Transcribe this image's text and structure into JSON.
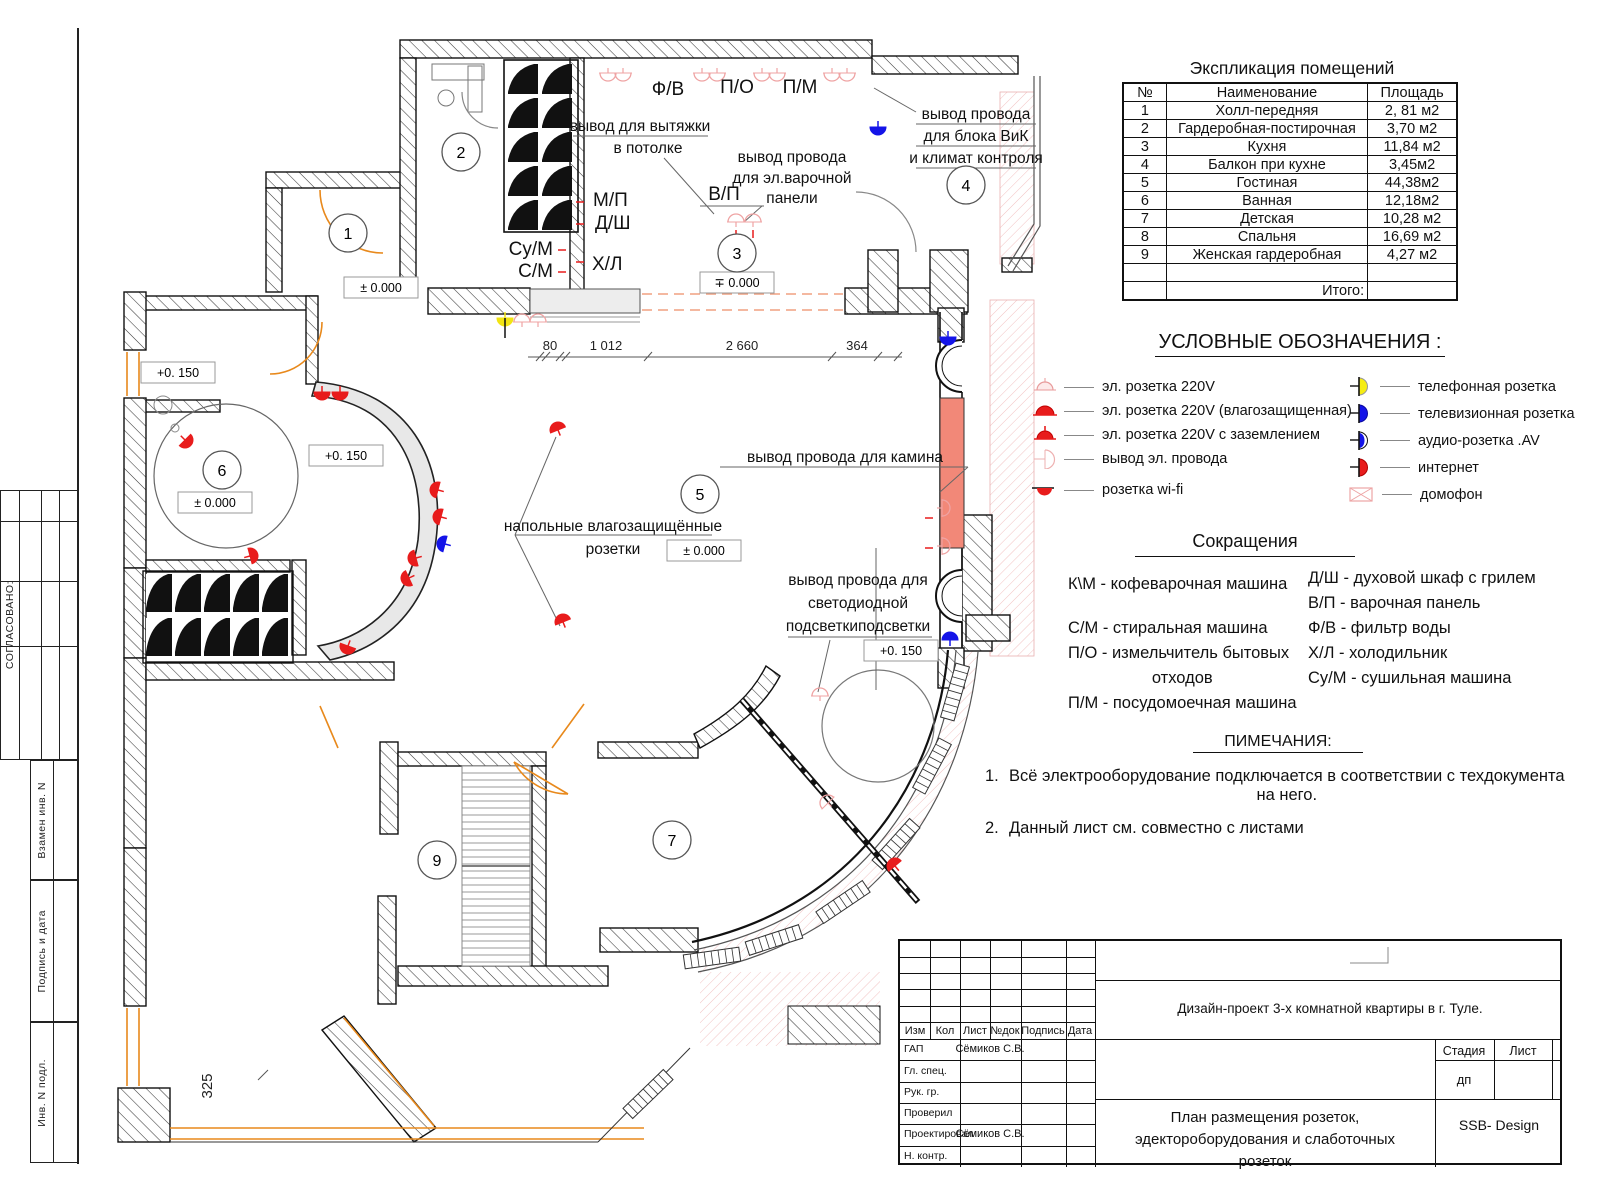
{
  "colors": {
    "socket_red": "#e81c1c",
    "socket_pale": "#efa3a3",
    "socket_blue": "#1414e8",
    "socket_yellow": "#f2e413",
    "fireplace": "#f28878",
    "door_orange": "#e8891c"
  },
  "stamp_column": {
    "approved": "СОГЛАСОВАНО:",
    "rows": [
      "Взамен инв. N",
      "Подпись и дата",
      "Инв. N подл."
    ]
  },
  "plan": {
    "rooms": [
      "1",
      "2",
      "3",
      "4",
      "5",
      "6",
      "7",
      "9"
    ],
    "appliance_labels": {
      "fv": "Ф/В",
      "po": "П/О",
      "pm": "П/М",
      "vp": "В/П",
      "mp": "М/П",
      "dsh": "Д/Ш",
      "sum": "Су/М",
      "sm": "С/М",
      "hl": "Х/Л"
    },
    "annotations": {
      "hood_1": "вывод для вытяжки",
      "hood_2": "в потолке",
      "hob_1": "вывод провода",
      "hob_2": "для эл.варочной",
      "hob_3": "панели",
      "vik_1": "вывод провода",
      "vik_2": "для блока ВиК",
      "vik_3": "и климат контроля",
      "fireplace": "вывод провода для камина",
      "floor_1": "напольные влагозащищённые",
      "floor_2": "розетки",
      "led_1": "вывод провода для",
      "led_2": "светодиодной",
      "led_3": "подсветкиподсветки"
    },
    "elevations": {
      "e1": "± 0.000",
      "e2": "∓ 0.000",
      "e3": "+0. 150",
      "e4": "± 0.000",
      "e5": "+0. 150",
      "e6": "± 0.000",
      "e7": "+0. 150"
    },
    "dimensions": {
      "d1": "80",
      "d2": "1 012",
      "d3": "2 660",
      "d4": "364",
      "d5": "325"
    }
  },
  "room_table": {
    "title": "Экспликация помещений",
    "headers": [
      "№",
      "Наименование",
      "Площадь"
    ],
    "rows": [
      [
        "1",
        "Холл-передняя",
        "2, 81 м2"
      ],
      [
        "2",
        "Гардеробная-постирочная",
        "3,70 м2"
      ],
      [
        "3",
        "Кухня",
        "11,84 м2"
      ],
      [
        "4",
        "Балкон при кухне",
        "3,45м2"
      ],
      [
        "5",
        "Гостиная",
        "44,38м2"
      ],
      [
        "6",
        "Ванная",
        "12,18м2"
      ],
      [
        "7",
        "Детская",
        "10,28 м2"
      ],
      [
        "8",
        "Спальня",
        "16,69 м2"
      ],
      [
        "9",
        "Женская гардеробная",
        "4,27 м2"
      ]
    ],
    "total_label": "Итого:"
  },
  "legend": {
    "title": "УСЛОВНЫЕ ОБОЗНАЧЕНИЯ :",
    "left": [
      {
        "icon": "socket-220v-icon",
        "label": "эл. розетка 220V"
      },
      {
        "icon": "socket-220v-moisture-icon",
        "label": "эл. розетка 220V (влагозащищенная)"
      },
      {
        "icon": "socket-220v-ground-icon",
        "label": "эл. розетка 220V с заземлением"
      },
      {
        "icon": "wire-outlet-icon",
        "label": "вывод эл. провода"
      },
      {
        "icon": "wifi-socket-icon",
        "label": "розетка wi-fi"
      }
    ],
    "right": [
      {
        "icon": "phone-socket-icon",
        "label": "телефонная розетка"
      },
      {
        "icon": "tv-socket-icon",
        "label": "телевизионная розетка"
      },
      {
        "icon": "audio-socket-icon",
        "label": "аудио-розетка .AV"
      },
      {
        "icon": "internet-socket-icon",
        "label": "интернет"
      },
      {
        "icon": "intercom-icon",
        "label": "домофон"
      }
    ]
  },
  "abbreviations": {
    "title": "Сокращения",
    "left": [
      "К\\М - кофеварочная машина",
      "С/М - стиральная машина",
      "П/О - измельчитель бытовых",
      "отходов",
      "П/М - посудомоечная машина"
    ],
    "right": [
      "Д/Ш - духовой шкаф с грилем",
      "В/П - варочная панель",
      "Ф/В - фильтр воды",
      "Х/Л - холодильник",
      "Су/М -  сушильная машина"
    ]
  },
  "notes": {
    "title": "ПИМЕЧАНИЯ:",
    "items": [
      {
        "num": "1.",
        "line1": "Всё электрооборудование подключается в соответствии с техдокумента",
        "line2": "на него."
      },
      {
        "num": "2.",
        "line1": "Данный лист см. совместно с листами",
        "line2": ""
      }
    ]
  },
  "title_block": {
    "project": "Дизайн-проект 3-х комнатной квартиры в г. Туле.",
    "header_cells": [
      "Изм",
      "Кол",
      "Лист",
      "№док",
      "Подпись",
      "Дата"
    ],
    "rows": [
      {
        "role": "ГАП",
        "name": "Сёмиков С.В."
      },
      {
        "role": "Гл. спец.",
        "name": ""
      },
      {
        "role": "Рук. гр.",
        "name": ""
      },
      {
        "role": "Проверил",
        "name": ""
      },
      {
        "role": "Проектировал",
        "name": "Сёмиков С.В."
      },
      {
        "role": "Н. контр.",
        "name": ""
      }
    ],
    "stage_label": "Стадия",
    "sheet_label": "Лист",
    "stage_value": "дп",
    "doc_title_1": "План размещения розеток,",
    "doc_title_2": "эдектороборудования и слаботочных",
    "doc_title_3": "розеток",
    "company": "SSB- Design"
  }
}
